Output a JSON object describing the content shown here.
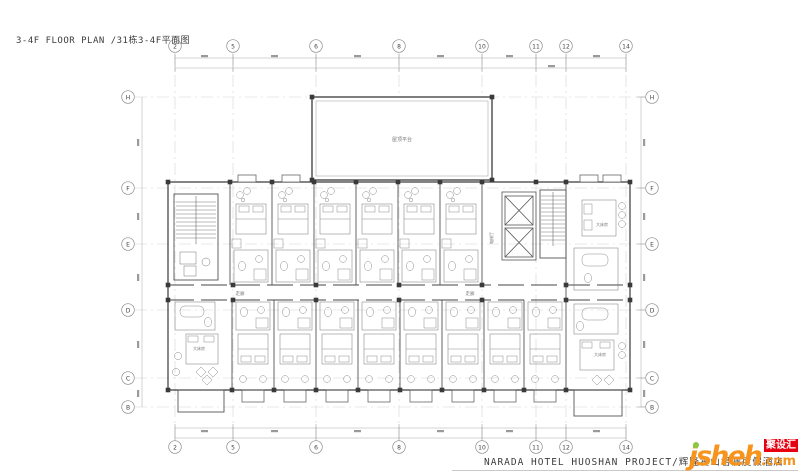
{
  "title": "3-4F FLOOR PLAN /31栋3-4F平面图",
  "grid": {
    "cols": [
      "2",
      "5",
      "6",
      "8",
      "10",
      "11",
      "12",
      "14"
    ],
    "rows": [
      "H",
      "F",
      "E",
      "D",
      "C",
      "B"
    ]
  },
  "plan": {
    "roof_terrace": "屋顶平台",
    "corridor": "走廊",
    "king_room": "大床房",
    "elevator_hall": "电梯厅"
  },
  "footer": {
    "project": "NARADA HOTEL HUOSHAN PROJECT/辉隆霍山君澜度假酒店"
  },
  "logo": {
    "name": "jsheh",
    "tld": ".com",
    "tag": "聚设汇"
  },
  "colors": {
    "logo_orange": "#F7941D",
    "logo_red": "#E60012",
    "logo_green": "#8DC63F",
    "wall_dark": "#3A3A3A",
    "line_light": "#9A9A9A"
  }
}
